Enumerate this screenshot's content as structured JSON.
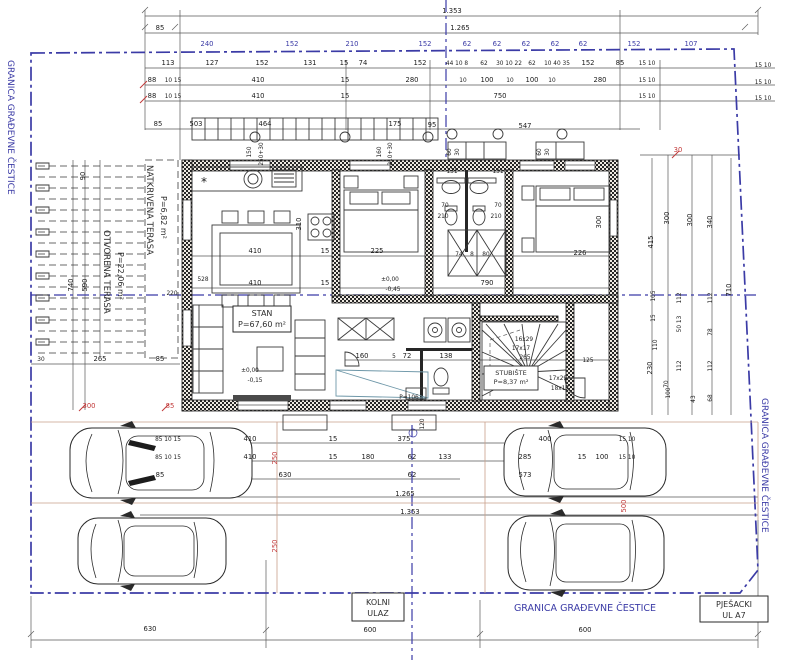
{
  "boundary": {
    "left_label": "GRANICA GRAĐEVNE ČESTICE",
    "right_label": "GRANICA GRAĐEVNE ČESTICE",
    "bottom_label": "GRANICA GRAĐEVNE ČESTICE",
    "color": "#3b3ba6"
  },
  "rooms": {
    "open_terrace": {
      "name": "OTVORENA TERASA",
      "area": "P=22,06 m²"
    },
    "covered_terrace": {
      "name": "NATKRIVENA TERASA",
      "area": "P=6,82 m²"
    },
    "apartment": {
      "name": "STAN",
      "area": "P=67,60 m²"
    },
    "stairs": {
      "name": "STUBIŠTE",
      "area": "P=8,37 m²"
    }
  },
  "entrances": {
    "driveway_line1": "KOLNI",
    "driveway_line2": "ULAZ",
    "pedestrian_line1": "PJEŠACKI",
    "pedestrian_line2": "UL A7"
  },
  "colors": {
    "dimension": "#1c1c1c",
    "red_dimension": "#c23b3b",
    "blue": "#3b3ba6"
  },
  "dimensions": [
    {
      "t": "1.353",
      "x": 452,
      "y": 13
    },
    {
      "t": "85",
      "x": 160,
      "y": 30
    },
    {
      "t": "1.265",
      "x": 460,
      "y": 30
    },
    {
      "t": "240",
      "x": 207,
      "y": 46,
      "c": "blue"
    },
    {
      "t": "152",
      "x": 292,
      "y": 46,
      "c": "blue"
    },
    {
      "t": "210",
      "x": 352,
      "y": 46,
      "c": "blue"
    },
    {
      "t": "152",
      "x": 425,
      "y": 46,
      "c": "blue"
    },
    {
      "t": "62",
      "x": 467,
      "y": 46,
      "c": "blue"
    },
    {
      "t": "62",
      "x": 497,
      "y": 46,
      "c": "blue"
    },
    {
      "t": "62",
      "x": 526,
      "y": 46,
      "c": "blue"
    },
    {
      "t": "62",
      "x": 555,
      "y": 46,
      "c": "blue"
    },
    {
      "t": "62",
      "x": 583,
      "y": 46,
      "c": "blue"
    },
    {
      "t": "152",
      "x": 634,
      "y": 46,
      "c": "blue"
    },
    {
      "t": "107",
      "x": 691,
      "y": 46,
      "c": "blue"
    },
    {
      "t": "113",
      "x": 168,
      "y": 65
    },
    {
      "t": "127",
      "x": 212,
      "y": 65
    },
    {
      "t": "152",
      "x": 262,
      "y": 65
    },
    {
      "t": "131",
      "x": 310,
      "y": 65
    },
    {
      "t": "15",
      "x": 344,
      "y": 65
    },
    {
      "t": "74",
      "x": 363,
      "y": 65
    },
    {
      "t": "152",
      "x": 420,
      "y": 65
    },
    {
      "t": "44 10 8",
      "x": 457,
      "y": 65,
      "s": 6
    },
    {
      "t": "62",
      "x": 484,
      "y": 65,
      "s": 6
    },
    {
      "t": "30 10 22",
      "x": 509,
      "y": 65,
      "s": 6
    },
    {
      "t": "62",
      "x": 532,
      "y": 65,
      "s": 6
    },
    {
      "t": "10 40 35",
      "x": 557,
      "y": 65,
      "s": 6
    },
    {
      "t": "152",
      "x": 588,
      "y": 65
    },
    {
      "t": "85",
      "x": 620,
      "y": 65
    },
    {
      "t": "15 10",
      "x": 647,
      "y": 65,
      "s": 6
    },
    {
      "t": "88",
      "x": 152,
      "y": 82
    },
    {
      "t": "10 15",
      "x": 173,
      "y": 82,
      "s": 6
    },
    {
      "t": "410",
      "x": 258,
      "y": 82
    },
    {
      "t": "15",
      "x": 345,
      "y": 82
    },
    {
      "t": "280",
      "x": 412,
      "y": 82
    },
    {
      "t": "10",
      "x": 463,
      "y": 82,
      "s": 6
    },
    {
      "t": "100",
      "x": 487,
      "y": 82
    },
    {
      "t": "10",
      "x": 510,
      "y": 82,
      "s": 6
    },
    {
      "t": "100",
      "x": 532,
      "y": 82
    },
    {
      "t": "10",
      "x": 552,
      "y": 82,
      "s": 6
    },
    {
      "t": "280",
      "x": 600,
      "y": 82
    },
    {
      "t": "15 10",
      "x": 647,
      "y": 82,
      "s": 6
    },
    {
      "t": "88",
      "x": 152,
      "y": 98
    },
    {
      "t": "10 15",
      "x": 173,
      "y": 98,
      "s": 6
    },
    {
      "t": "410",
      "x": 258,
      "y": 98
    },
    {
      "t": "15",
      "x": 345,
      "y": 98
    },
    {
      "t": "750",
      "x": 500,
      "y": 98
    },
    {
      "t": "15 10",
      "x": 647,
      "y": 98,
      "s": 6
    },
    {
      "t": "15 10",
      "x": 763,
      "y": 67,
      "s": 6
    },
    {
      "t": "15 10",
      "x": 763,
      "y": 84,
      "s": 6
    },
    {
      "t": "15 10",
      "x": 763,
      "y": 100,
      "s": 6
    },
    {
      "t": "85",
      "x": 158,
      "y": 126
    },
    {
      "t": "503",
      "x": 196,
      "y": 126
    },
    {
      "t": "464",
      "x": 265,
      "y": 126
    },
    {
      "t": "175",
      "x": 395,
      "y": 126
    },
    {
      "t": "95",
      "x": 432,
      "y": 127
    },
    {
      "t": "547",
      "x": 525,
      "y": 128
    },
    {
      "t": "30",
      "x": 678,
      "y": 152,
      "c": "red"
    },
    {
      "t": "90",
      "x": 85,
      "y": 176,
      "r": -90
    },
    {
      "t": "740",
      "x": 73,
      "y": 285,
      "r": -90
    },
    {
      "t": "590",
      "x": 87,
      "y": 285,
      "r": -90
    },
    {
      "t": "528",
      "x": 203,
      "y": 281,
      "s": 6
    },
    {
      "t": "220",
      "x": 172,
      "y": 295,
      "s": 6
    },
    {
      "t": "30",
      "x": 41,
      "y": 361,
      "s": 6
    },
    {
      "t": "265",
      "x": 100,
      "y": 361
    },
    {
      "t": "85",
      "x": 160,
      "y": 361
    },
    {
      "t": "300",
      "x": 89,
      "y": 408,
      "c": "red"
    },
    {
      "t": "85",
      "x": 170,
      "y": 408,
      "c": "red"
    },
    {
      "t": "150",
      "x": 251,
      "y": 152,
      "r": -90,
      "s": 6
    },
    {
      "t": "250+30",
      "x": 263,
      "y": 154,
      "r": -90,
      "s": 6
    },
    {
      "t": "160",
      "x": 381,
      "y": 152,
      "r": -90,
      "s": 6
    },
    {
      "t": "210+30",
      "x": 392,
      "y": 154,
      "r": -90,
      "s": 6
    },
    {
      "t": "310",
      "x": 301,
      "y": 224,
      "r": -90
    },
    {
      "t": "410",
      "x": 255,
      "y": 253
    },
    {
      "t": "15",
      "x": 325,
      "y": 253
    },
    {
      "t": "225",
      "x": 377,
      "y": 253
    },
    {
      "t": "410",
      "x": 255,
      "y": 285
    },
    {
      "t": "15",
      "x": 325,
      "y": 285
    },
    {
      "t": "790",
      "x": 487,
      "y": 285
    },
    {
      "t": "±0,00",
      "x": 390,
      "y": 281,
      "s": 6
    },
    {
      "t": "-0,45",
      "x": 393,
      "y": 291,
      "s": 6
    },
    {
      "t": "±0,00",
      "x": 250,
      "y": 372,
      "s": 6
    },
    {
      "t": "-0,15",
      "x": 255,
      "y": 382,
      "s": 6
    },
    {
      "t": "131",
      "x": 452,
      "y": 173,
      "s": 6
    },
    {
      "t": "131",
      "x": 498,
      "y": 173,
      "s": 6
    },
    {
      "t": "70",
      "x": 445,
      "y": 207,
      "s": 6
    },
    {
      "t": "70",
      "x": 498,
      "y": 207,
      "s": 6
    },
    {
      "t": "210",
      "x": 443,
      "y": 218,
      "s": 6
    },
    {
      "t": "210",
      "x": 496,
      "y": 218,
      "s": 6
    },
    {
      "t": "74",
      "x": 459,
      "y": 256,
      "s": 6
    },
    {
      "t": "8",
      "x": 472,
      "y": 256,
      "s": 6
    },
    {
      "t": "80",
      "x": 486,
      "y": 256,
      "s": 6
    },
    {
      "t": "226",
      "x": 580,
      "y": 255
    },
    {
      "t": "300",
      "x": 601,
      "y": 222,
      "r": -90
    },
    {
      "t": "160",
      "x": 362,
      "y": 358
    },
    {
      "t": "5",
      "x": 394,
      "y": 358,
      "s": 6
    },
    {
      "t": "72",
      "x": 407,
      "y": 358
    },
    {
      "t": "138",
      "x": 446,
      "y": 358
    },
    {
      "t": "125",
      "x": 588,
      "y": 362,
      "s": 6
    },
    {
      "t": "P=106",
      "x": 409,
      "y": 399,
      "s": 6
    },
    {
      "t": "16x29",
      "x": 524,
      "y": 341,
      "s": 6
    },
    {
      "t": "17x17",
      "x": 521,
      "y": 350,
      "s": 6
    },
    {
      "t": "265",
      "x": 525,
      "y": 359,
      "s": 6
    },
    {
      "t": "17x29",
      "x": 558,
      "y": 380,
      "s": 6
    },
    {
      "t": "18x17",
      "x": 560,
      "y": 390,
      "s": 6
    },
    {
      "t": "60",
      "x": 451,
      "y": 152,
      "r": -90,
      "s": 6
    },
    {
      "t": "30",
      "x": 459,
      "y": 152,
      "r": -90,
      "s": 6
    },
    {
      "t": "60",
      "x": 541,
      "y": 152,
      "r": -90,
      "s": 6
    },
    {
      "t": "30",
      "x": 549,
      "y": 152,
      "r": -90,
      "s": 6
    },
    {
      "t": "415",
      "x": 653,
      "y": 242,
      "r": -90
    },
    {
      "t": "300",
      "x": 669,
      "y": 218,
      "r": -90
    },
    {
      "t": "300",
      "x": 692,
      "y": 220,
      "r": -90
    },
    {
      "t": "340",
      "x": 712,
      "y": 222,
      "r": -90
    },
    {
      "t": "710",
      "x": 731,
      "y": 290,
      "r": -90
    },
    {
      "t": "105",
      "x": 655,
      "y": 296,
      "r": -90,
      "s": 6
    },
    {
      "t": "112",
      "x": 681,
      "y": 298,
      "r": -90,
      "s": 6
    },
    {
      "t": "112",
      "x": 712,
      "y": 298,
      "r": -90,
      "s": 6
    },
    {
      "t": "15",
      "x": 655,
      "y": 318,
      "r": -90,
      "s": 6
    },
    {
      "t": "50 13",
      "x": 681,
      "y": 324,
      "r": -90,
      "s": 6
    },
    {
      "t": "78",
      "x": 712,
      "y": 332,
      "r": -90,
      "s": 6
    },
    {
      "t": "110",
      "x": 657,
      "y": 345,
      "r": -90,
      "s": 6
    },
    {
      "t": "230",
      "x": 652,
      "y": 368,
      "r": -90
    },
    {
      "t": "112",
      "x": 681,
      "y": 366,
      "r": -90,
      "s": 6
    },
    {
      "t": "112",
      "x": 712,
      "y": 366,
      "r": -90,
      "s": 6
    },
    {
      "t": "70",
      "x": 668,
      "y": 384,
      "r": -90,
      "s": 6
    },
    {
      "t": "100",
      "x": 670,
      "y": 393,
      "r": -90,
      "s": 6
    },
    {
      "t": "68",
      "x": 712,
      "y": 398,
      "r": -90,
      "s": 6
    },
    {
      "t": "43",
      "x": 695,
      "y": 399,
      "r": -90,
      "s": 6
    },
    {
      "t": "*",
      "x": 204,
      "y": 186,
      "s": 12
    },
    {
      "t": "85 10 15",
      "x": 168,
      "y": 441,
      "s": 6
    },
    {
      "t": "410",
      "x": 250,
      "y": 441
    },
    {
      "t": "15",
      "x": 333,
      "y": 441
    },
    {
      "t": "375",
      "x": 404,
      "y": 441
    },
    {
      "t": "400",
      "x": 545,
      "y": 441
    },
    {
      "t": "15 10",
      "x": 627,
      "y": 441,
      "s": 6
    },
    {
      "t": "85 10 15",
      "x": 168,
      "y": 459,
      "s": 6
    },
    {
      "t": "410",
      "x": 250,
      "y": 459
    },
    {
      "t": "15",
      "x": 333,
      "y": 459
    },
    {
      "t": "180",
      "x": 368,
      "y": 459
    },
    {
      "t": "62",
      "x": 412,
      "y": 459
    },
    {
      "t": "133",
      "x": 445,
      "y": 459
    },
    {
      "t": "285",
      "x": 525,
      "y": 459
    },
    {
      "t": "15",
      "x": 582,
      "y": 459
    },
    {
      "t": "100",
      "x": 602,
      "y": 459
    },
    {
      "t": "15 10",
      "x": 627,
      "y": 459,
      "s": 6
    },
    {
      "t": "85",
      "x": 160,
      "y": 477
    },
    {
      "t": "630",
      "x": 285,
      "y": 477
    },
    {
      "t": "62",
      "x": 412,
      "y": 477
    },
    {
      "t": "573",
      "x": 525,
      "y": 477
    },
    {
      "t": "1.265",
      "x": 405,
      "y": 496
    },
    {
      "t": "1.353",
      "x": 410,
      "y": 514
    },
    {
      "t": "250",
      "x": 277,
      "y": 458,
      "r": -90,
      "c": "red"
    },
    {
      "t": "250",
      "x": 277,
      "y": 546,
      "r": -90,
      "c": "red"
    },
    {
      "t": "500",
      "x": 626,
      "y": 506,
      "r": -90,
      "c": "red"
    },
    {
      "t": "120",
      "x": 424,
      "y": 424,
      "r": -90,
      "s": 6
    },
    {
      "t": "630",
      "x": 150,
      "y": 631
    },
    {
      "t": "600",
      "x": 370,
      "y": 632
    },
    {
      "t": "600",
      "x": 585,
      "y": 632
    }
  ]
}
